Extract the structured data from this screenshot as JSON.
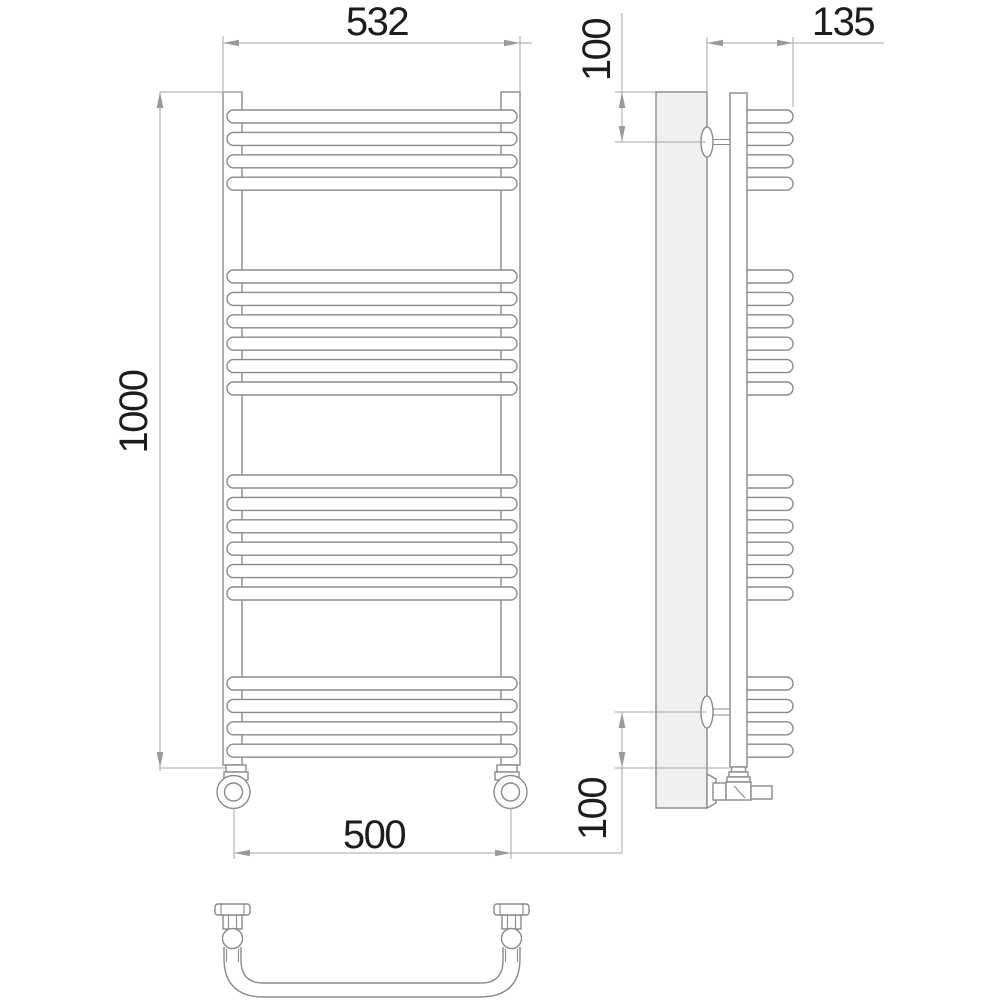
{
  "drawing": {
    "type": "technical-drawing",
    "subject": "ladder towel rail - front, side and bottom views",
    "colors": {
      "object_line": "#8a8a8a",
      "dimension_line": "#a6a6a6",
      "arrow": "#9a9a9a",
      "text": "#1d1d1d",
      "wall_panel_fill": "#f0f0f0",
      "background": "#ffffff"
    },
    "dimensions": {
      "top_width": "532",
      "height": "1000",
      "bottom_width": "500",
      "depth": "135",
      "top_bracket_offset": "100",
      "bottom_bracket_offset": "100"
    },
    "rungs": {
      "group_counts": [
        4,
        6,
        6,
        4
      ],
      "group_start_y": [
        110,
        270,
        475,
        677
      ],
      "pitch": 22.4,
      "height": 13
    }
  }
}
